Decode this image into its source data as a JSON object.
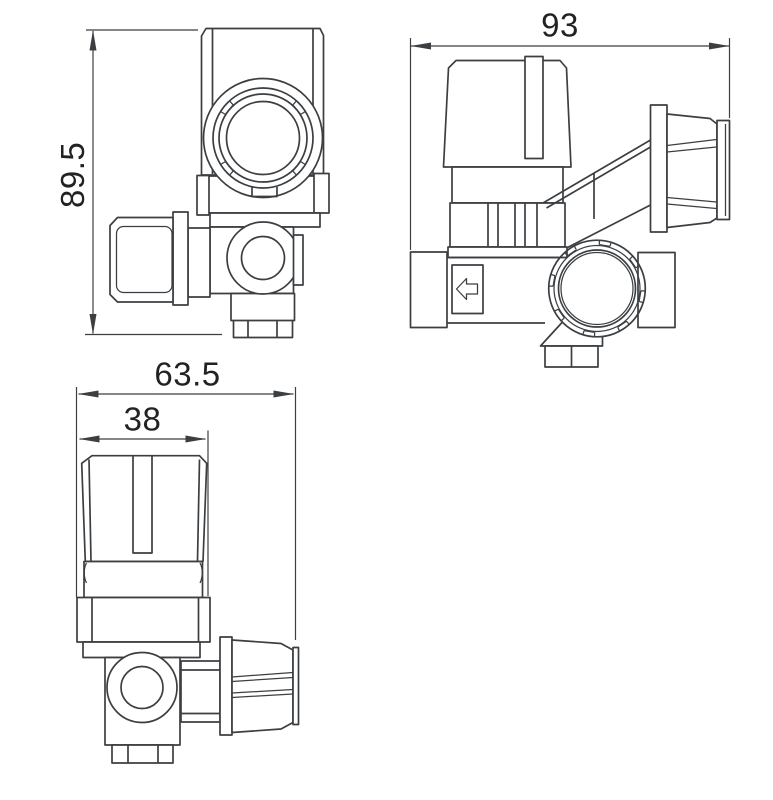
{
  "drawing": {
    "background_color": "#ffffff",
    "line_color": "#3c3f42",
    "text_color": "#222222",
    "dimensions": {
      "height": "89.5",
      "width": "93",
      "overall_width": "63.5",
      "knob_width": "38"
    },
    "icons": {
      "flow_direction": "left-arrow-icon"
    }
  }
}
